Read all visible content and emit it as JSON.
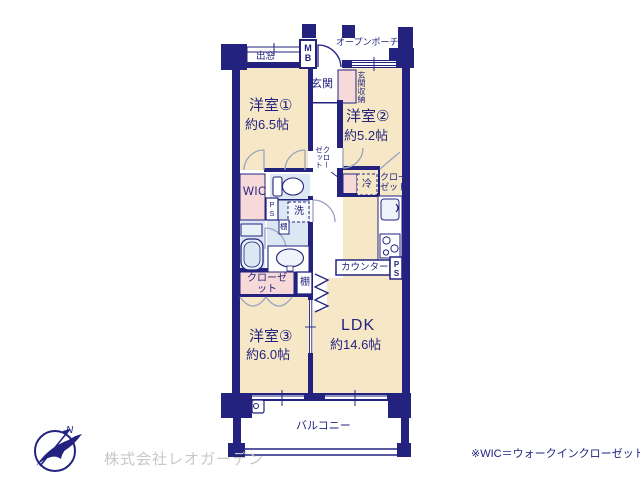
{
  "rooms": {
    "room1": {
      "name": "洋室①",
      "size": "約6.5帖"
    },
    "room2": {
      "name": "洋室②",
      "size": "約5.2帖"
    },
    "room3": {
      "name": "洋室③",
      "size": "約6.0帖"
    },
    "ldk": {
      "name": "LDK",
      "size": "約14.6帖"
    }
  },
  "labels": {
    "bay_window": "出窓",
    "meter_box": "MB",
    "open_porch": "オープンポーチ",
    "entrance": "玄関",
    "entrance_storage": "玄関収納",
    "hall_closet": "クローゼット",
    "wic": "WIC",
    "ps_top": "PS",
    "laundry": "洗",
    "shelf_small": "棚",
    "fridge": "冷",
    "kitchen_closet": "クローゼット",
    "room3_closet": "クローゼット",
    "shelf": "棚",
    "counter": "カウンター",
    "ps_bottom": "PS",
    "balcony": "バルコニー"
  },
  "compass": {
    "north": "N"
  },
  "footer": {
    "company": "株式会社レオガーデン",
    "wic_note": "※WIC＝ウォークインクローゼット"
  },
  "colors": {
    "wall_navy": "#23237f",
    "room_cream": "#f6e8c6",
    "closet_pink": "#f8d9d9",
    "wet_blue": "#dbe7f3",
    "logo_gray": "#c7c7c7"
  }
}
